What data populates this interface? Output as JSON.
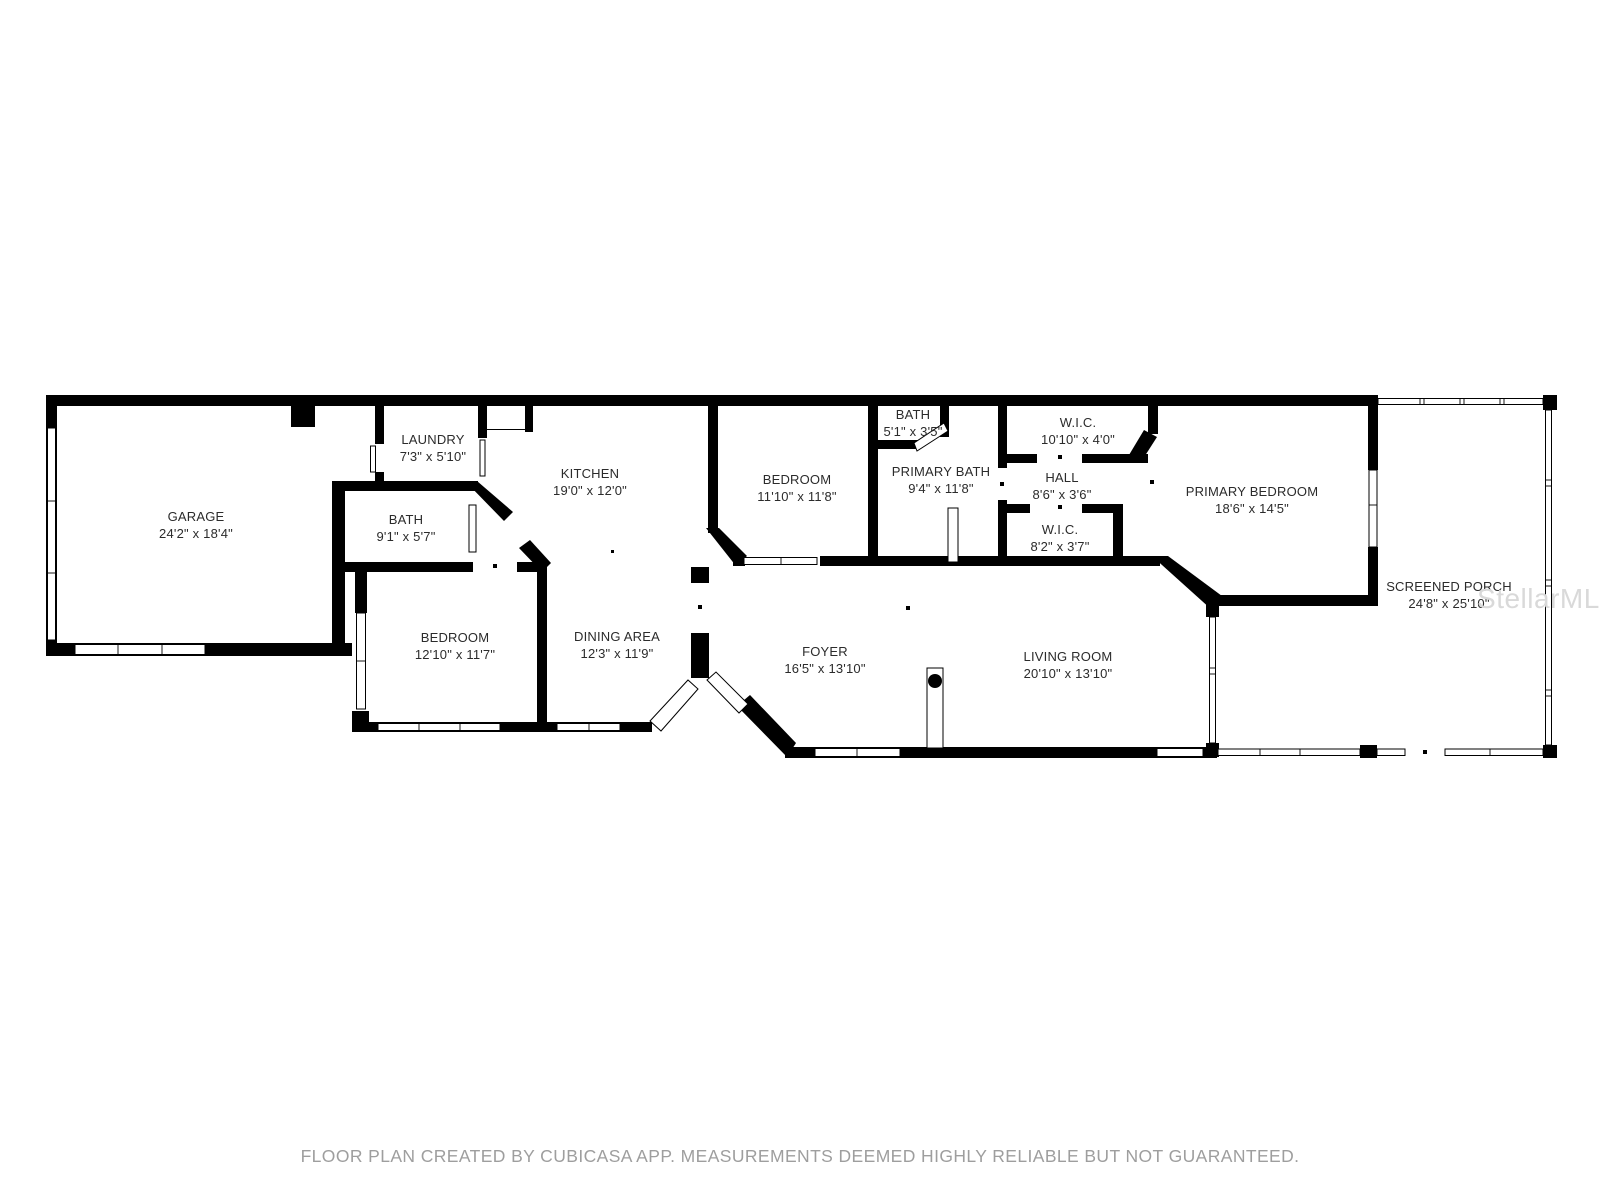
{
  "floor_plan": {
    "rooms": [
      {
        "id": "garage",
        "name": "GARAGE",
        "dims": "24'2\" x 18'4\""
      },
      {
        "id": "laundry",
        "name": "LAUNDRY",
        "dims": "7'3\" x 5'10\""
      },
      {
        "id": "bath-1",
        "name": "BATH",
        "dims": "9'1\" x 5'7\""
      },
      {
        "id": "kitchen",
        "name": "KITCHEN",
        "dims": "19'0\" x 12'0\""
      },
      {
        "id": "bedroom-top",
        "name": "BEDROOM",
        "dims": "11'10\" x 11'8\""
      },
      {
        "id": "bath-2",
        "name": "BATH",
        "dims": "5'1\" x 3'5\""
      },
      {
        "id": "primary-bath",
        "name": "PRIMARY BATH",
        "dims": "9'4\" x 11'8\""
      },
      {
        "id": "wic-1",
        "name": "W.I.C.",
        "dims": "10'10\" x 4'0\""
      },
      {
        "id": "hall",
        "name": "HALL",
        "dims": "8'6\" x 3'6\""
      },
      {
        "id": "wic-2",
        "name": "W.I.C.",
        "dims": "8'2\" x 3'7\""
      },
      {
        "id": "primary-bedroom",
        "name": "PRIMARY BEDROOM",
        "dims": "18'6\" x 14'5\""
      },
      {
        "id": "screened-porch",
        "name": "SCREENED PORCH",
        "dims": "24'8\" x 25'10\""
      },
      {
        "id": "bedroom-bottom",
        "name": "BEDROOM",
        "dims": "12'10\" x 11'7\""
      },
      {
        "id": "dining-area",
        "name": "DINING AREA",
        "dims": "12'3\" x 11'9\""
      },
      {
        "id": "foyer",
        "name": "FOYER",
        "dims": "16'5\" x 13'10\""
      },
      {
        "id": "living-room",
        "name": "LIVING ROOM",
        "dims": "20'10\" x 13'10\""
      }
    ],
    "colors": {
      "wall": "#000000",
      "label": "#2b2b2b",
      "watermark": "#d9d9d9",
      "footer": "#9e9e9e",
      "background": "#ffffff"
    }
  },
  "watermark": {
    "text": "StellarMLS"
  },
  "footer": {
    "disclaimer": "FLOOR PLAN CREATED BY CUBICASA APP. MEASUREMENTS DEEMED HIGHLY RELIABLE BUT NOT GUARANTEED."
  }
}
